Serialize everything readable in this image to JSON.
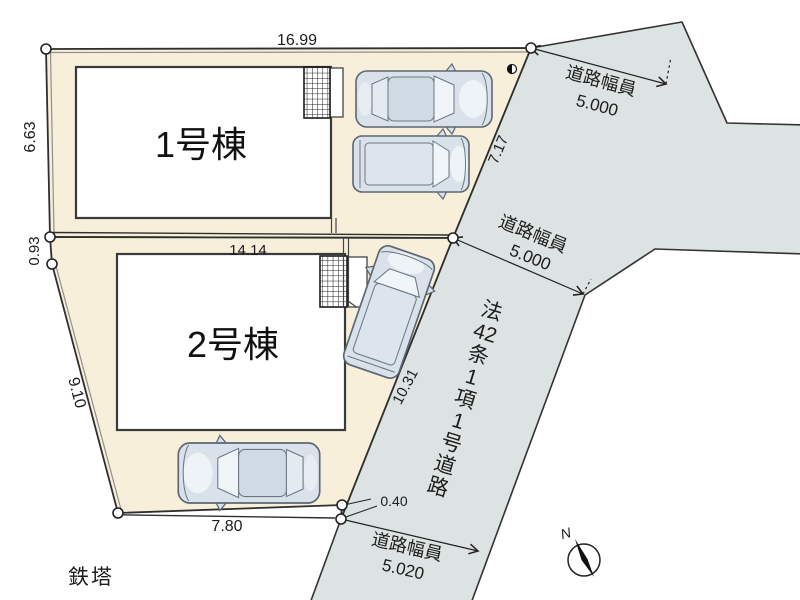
{
  "plan": {
    "buildings": [
      {
        "label": "1号棟"
      },
      {
        "label": "2号棟"
      }
    ],
    "dimensions": {
      "lot1_top": "16.99",
      "lot1_left": "6.63",
      "left_offset": "0.93",
      "lot2_left": "9.10",
      "lot2_bottom": "7.80",
      "lot2_top": "14.14",
      "road_edge_upper": "7.17",
      "road_edge_lower": "10.31",
      "corner_offset": "0.40"
    },
    "road": {
      "width_label_top": {
        "title": "道路幅員",
        "value": "5.000"
      },
      "width_label_mid": {
        "title": "道路幅員",
        "value": "5.000"
      },
      "width_label_bottom": {
        "title": "道路幅員",
        "value": "5.020"
      },
      "law_chars": [
        "法",
        "42",
        "条",
        "1",
        "項",
        "1",
        "号",
        "道",
        "路"
      ]
    },
    "landmarks": {
      "tower": "鉄塔",
      "compass_north": "N"
    },
    "colors": {
      "lot_fill": "#f8efda",
      "road_fill": "#dce3e2",
      "line": "#2f2f2f",
      "car_body": "#d9e2ea",
      "car_glass": "#cfdae4"
    }
  }
}
